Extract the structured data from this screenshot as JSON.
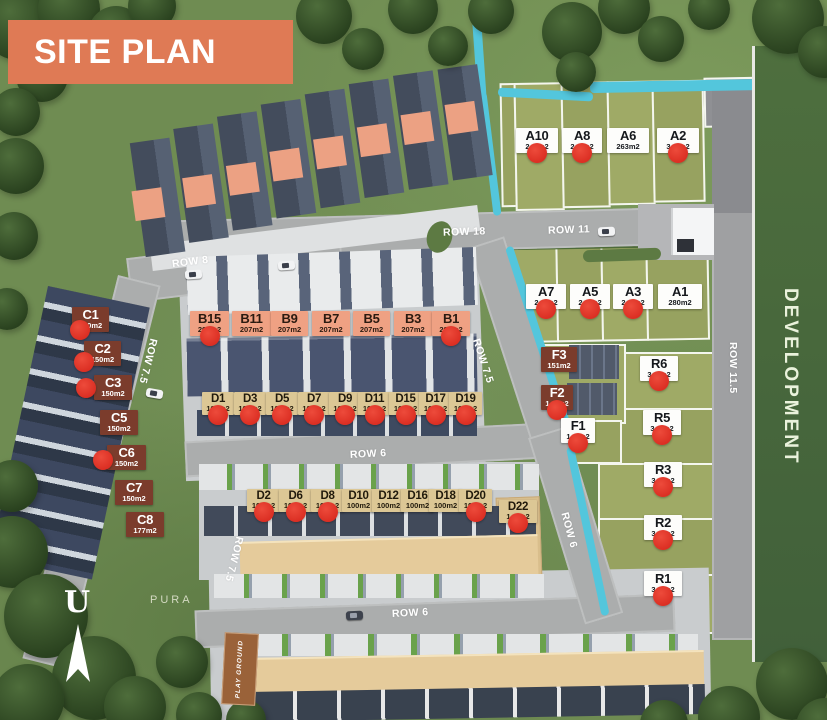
{
  "title": "SITE PLAN",
  "legend": {
    "development": "DEVELOPMENT",
    "pura": "PURA",
    "playground": "PLAY GROUND",
    "north": "U"
  },
  "roads": {
    "row18": "ROW 18",
    "row11": "ROW 11",
    "row8": "ROW 8",
    "row75_left": "ROW 7.5",
    "row75_center": "ROW 7.5",
    "row75_bottom": "ROW 7.5",
    "row6_mid": "ROW 6",
    "row6_bottom": "ROW 6",
    "row6_right": "ROW 6",
    "row115": "ROW 11.5"
  },
  "colors": {
    "banner": "#DF7A55",
    "sold_dot": "#E23A2C",
    "canal": "#53C6DC",
    "parcel_green": "#9FAA66",
    "road_gray": "#ABADAD",
    "label_salmon": "#EFA183",
    "label_tan": "#DCC795",
    "label_brown": "#7B3C2C",
    "development_bg": "#4E6F3E"
  },
  "lots": {
    "a_top": [
      {
        "id": "A10",
        "area": "2__m2",
        "sold": true
      },
      {
        "id": "A8",
        "area": "2__m2",
        "sold": true
      },
      {
        "id": "A6",
        "area": "263m2",
        "sold": false
      },
      {
        "id": "A2",
        "area": "3__m2",
        "sold": true
      }
    ],
    "a_bottom": [
      {
        "id": "A7",
        "area": "2__m2",
        "sold": true
      },
      {
        "id": "A5",
        "area": "2__m2",
        "sold": true
      },
      {
        "id": "A3",
        "area": "2__m2",
        "sold": true
      },
      {
        "id": "A1",
        "area": "280m2",
        "sold": false
      }
    ],
    "b_row": [
      {
        "id": "B15",
        "area": "207m2",
        "sold": true
      },
      {
        "id": "B11",
        "area": "207m2",
        "sold": false
      },
      {
        "id": "B9",
        "area": "207m2",
        "sold": false
      },
      {
        "id": "B7",
        "area": "207m2",
        "sold": false
      },
      {
        "id": "B5",
        "area": "207m2",
        "sold": false
      },
      {
        "id": "B3",
        "area": "207m2",
        "sold": false
      },
      {
        "id": "B1",
        "area": "207m2",
        "sold": true
      }
    ],
    "c_col": [
      {
        "id": "C1",
        "area": "150m2",
        "sold": true
      },
      {
        "id": "C2",
        "area": "150m2",
        "sold": true
      },
      {
        "id": "C3",
        "area": "150m2",
        "sold": true
      },
      {
        "id": "C5",
        "area": "150m2",
        "sold": false
      },
      {
        "id": "C6",
        "area": "150m2",
        "sold": true
      },
      {
        "id": "C7",
        "area": "150m2",
        "sold": false
      },
      {
        "id": "C8",
        "area": "177m2",
        "sold": false
      }
    ],
    "d_row1": [
      {
        "id": "D1",
        "area": "100m2",
        "sold": true
      },
      {
        "id": "D3",
        "area": "100m2",
        "sold": true
      },
      {
        "id": "D5",
        "area": "100m2",
        "sold": true
      },
      {
        "id": "D7",
        "area": "100m2",
        "sold": true
      },
      {
        "id": "D9",
        "area": "100m2",
        "sold": true
      },
      {
        "id": "D11",
        "area": "100m2",
        "sold": true
      },
      {
        "id": "D15",
        "area": "100m2",
        "sold": true
      },
      {
        "id": "D17",
        "area": "100m2",
        "sold": true
      },
      {
        "id": "D19",
        "area": "100m2",
        "sold": true
      }
    ],
    "d_row2": [
      {
        "id": "D2",
        "area": "100m2",
        "sold": true
      },
      {
        "id": "D6",
        "area": "100m2",
        "sold": true
      },
      {
        "id": "D8",
        "area": "100m2",
        "sold": true
      },
      {
        "id": "D10",
        "area": "100m2",
        "sold": false
      },
      {
        "id": "D12",
        "area": "100m2",
        "sold": false
      },
      {
        "id": "D16",
        "area": "100m2",
        "sold": false
      },
      {
        "id": "D18",
        "area": "100m2",
        "sold": false
      },
      {
        "id": "D20",
        "area": "100m2",
        "sold": true
      },
      {
        "id": "D22",
        "area": "1__m2",
        "sold": true
      }
    ],
    "f_col": [
      {
        "id": "F3",
        "area": "151m2",
        "sold": false
      },
      {
        "id": "F2",
        "area": "1__m2",
        "sold": true
      },
      {
        "id": "F1",
        "area": "1__m2",
        "sold": true
      }
    ],
    "r_col": [
      {
        "id": "R6",
        "area": "3__m2",
        "sold": true
      },
      {
        "id": "R5",
        "area": "3__m2",
        "sold": true
      },
      {
        "id": "R3",
        "area": "3__m2",
        "sold": true
      },
      {
        "id": "R2",
        "area": "3__m2",
        "sold": true
      },
      {
        "id": "R1",
        "area": "3__m2",
        "sold": true
      }
    ]
  }
}
